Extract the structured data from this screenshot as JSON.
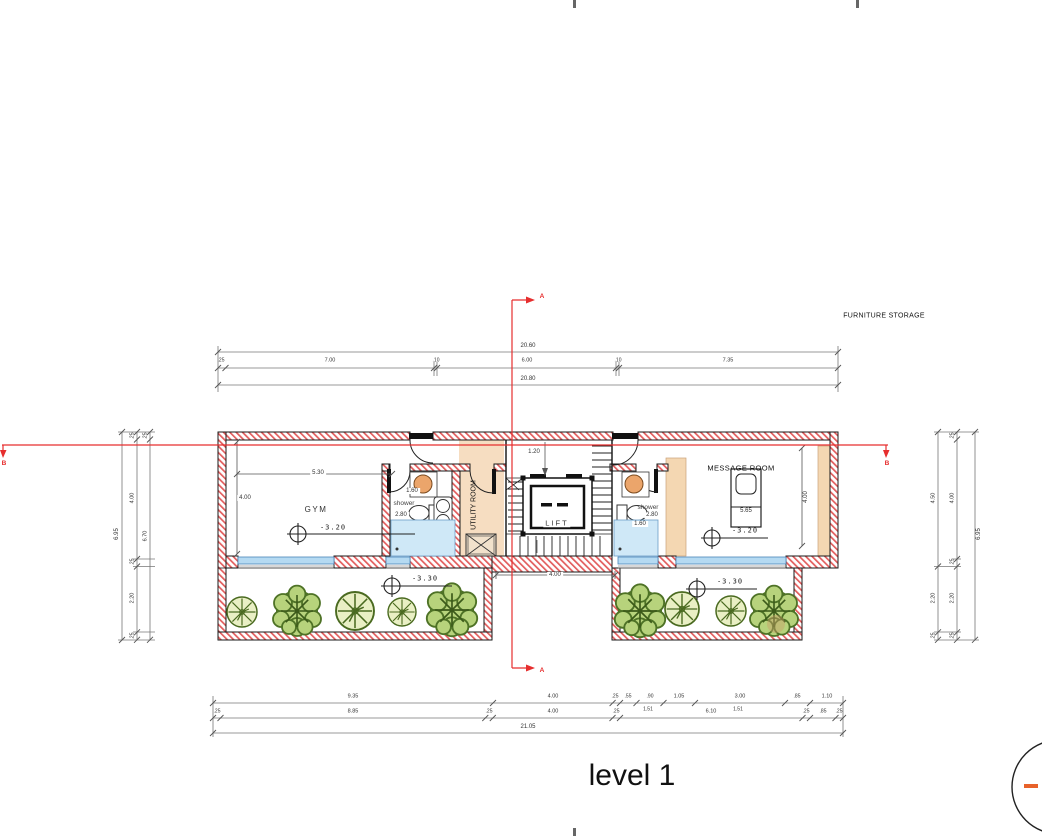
{
  "title": {
    "text": "level 1"
  },
  "notes": {
    "furniture_storage": "FURNITURE STORAGE"
  },
  "rooms": {
    "gym": "GYM",
    "message": "MESSAGE ROOM",
    "utility": "UTILITY ROOM",
    "lift": "LIFT",
    "shower_left": "shower",
    "shower_right": "shower"
  },
  "levels": {
    "gym": "-3.20",
    "message": "-3.20",
    "planter_left": "-3.30",
    "planter_right": "-3.30"
  },
  "sections": {
    "a": "A",
    "b": "B"
  },
  "dims": {
    "top": {
      "overall_upper": "20.60",
      "segments": [
        ".25",
        "7.00",
        ".10",
        "6.00",
        ".10",
        "7.35"
      ],
      "overall_lower": "20.80"
    },
    "bottom": {
      "row1": [
        "9.35",
        "4.00",
        ".25",
        ".55",
        ".90",
        "1.05",
        "3.00",
        ".85",
        "1.10"
      ],
      "subs": [
        "1.51",
        "1.51"
      ],
      "row2": [
        ".25",
        "8.85",
        ".25",
        "4.00",
        ".25",
        "6.10",
        ".25",
        ".85",
        ".25"
      ],
      "total": "21.05"
    },
    "left": {
      "overall": "6.95",
      "mid": [
        ".25",
        "4.00",
        ".25",
        "2.20",
        ".25"
      ],
      "inner": [
        ".25",
        "6.70"
      ]
    },
    "right": {
      "room": [
        "4.50",
        "2.20",
        ".25"
      ],
      "mid": [
        ".25",
        "4.00",
        ".25",
        "2.20",
        ".25"
      ],
      "overall": "6.95"
    },
    "interior": {
      "gym_width": "5.30",
      "gym_depth": "4.00",
      "shower_left_width": "1.60",
      "shower_left_depth": "2.80",
      "lift_offset": "1.20",
      "stair_bay": "4.00",
      "shower_right_width": "1.60",
      "shower_right_depth": "2.80",
      "massage_table": "5.65",
      "message_depth": "4.00"
    }
  },
  "colors": {
    "wall_hatch": "#e25c5c",
    "window": "#b5daf2",
    "floor_tan": "#f4d7b2",
    "tree_light": "#e9efc4",
    "tree_dark": "#b7d37c",
    "section_line": "#e62e2e",
    "marker_orange": "#e8622a"
  }
}
